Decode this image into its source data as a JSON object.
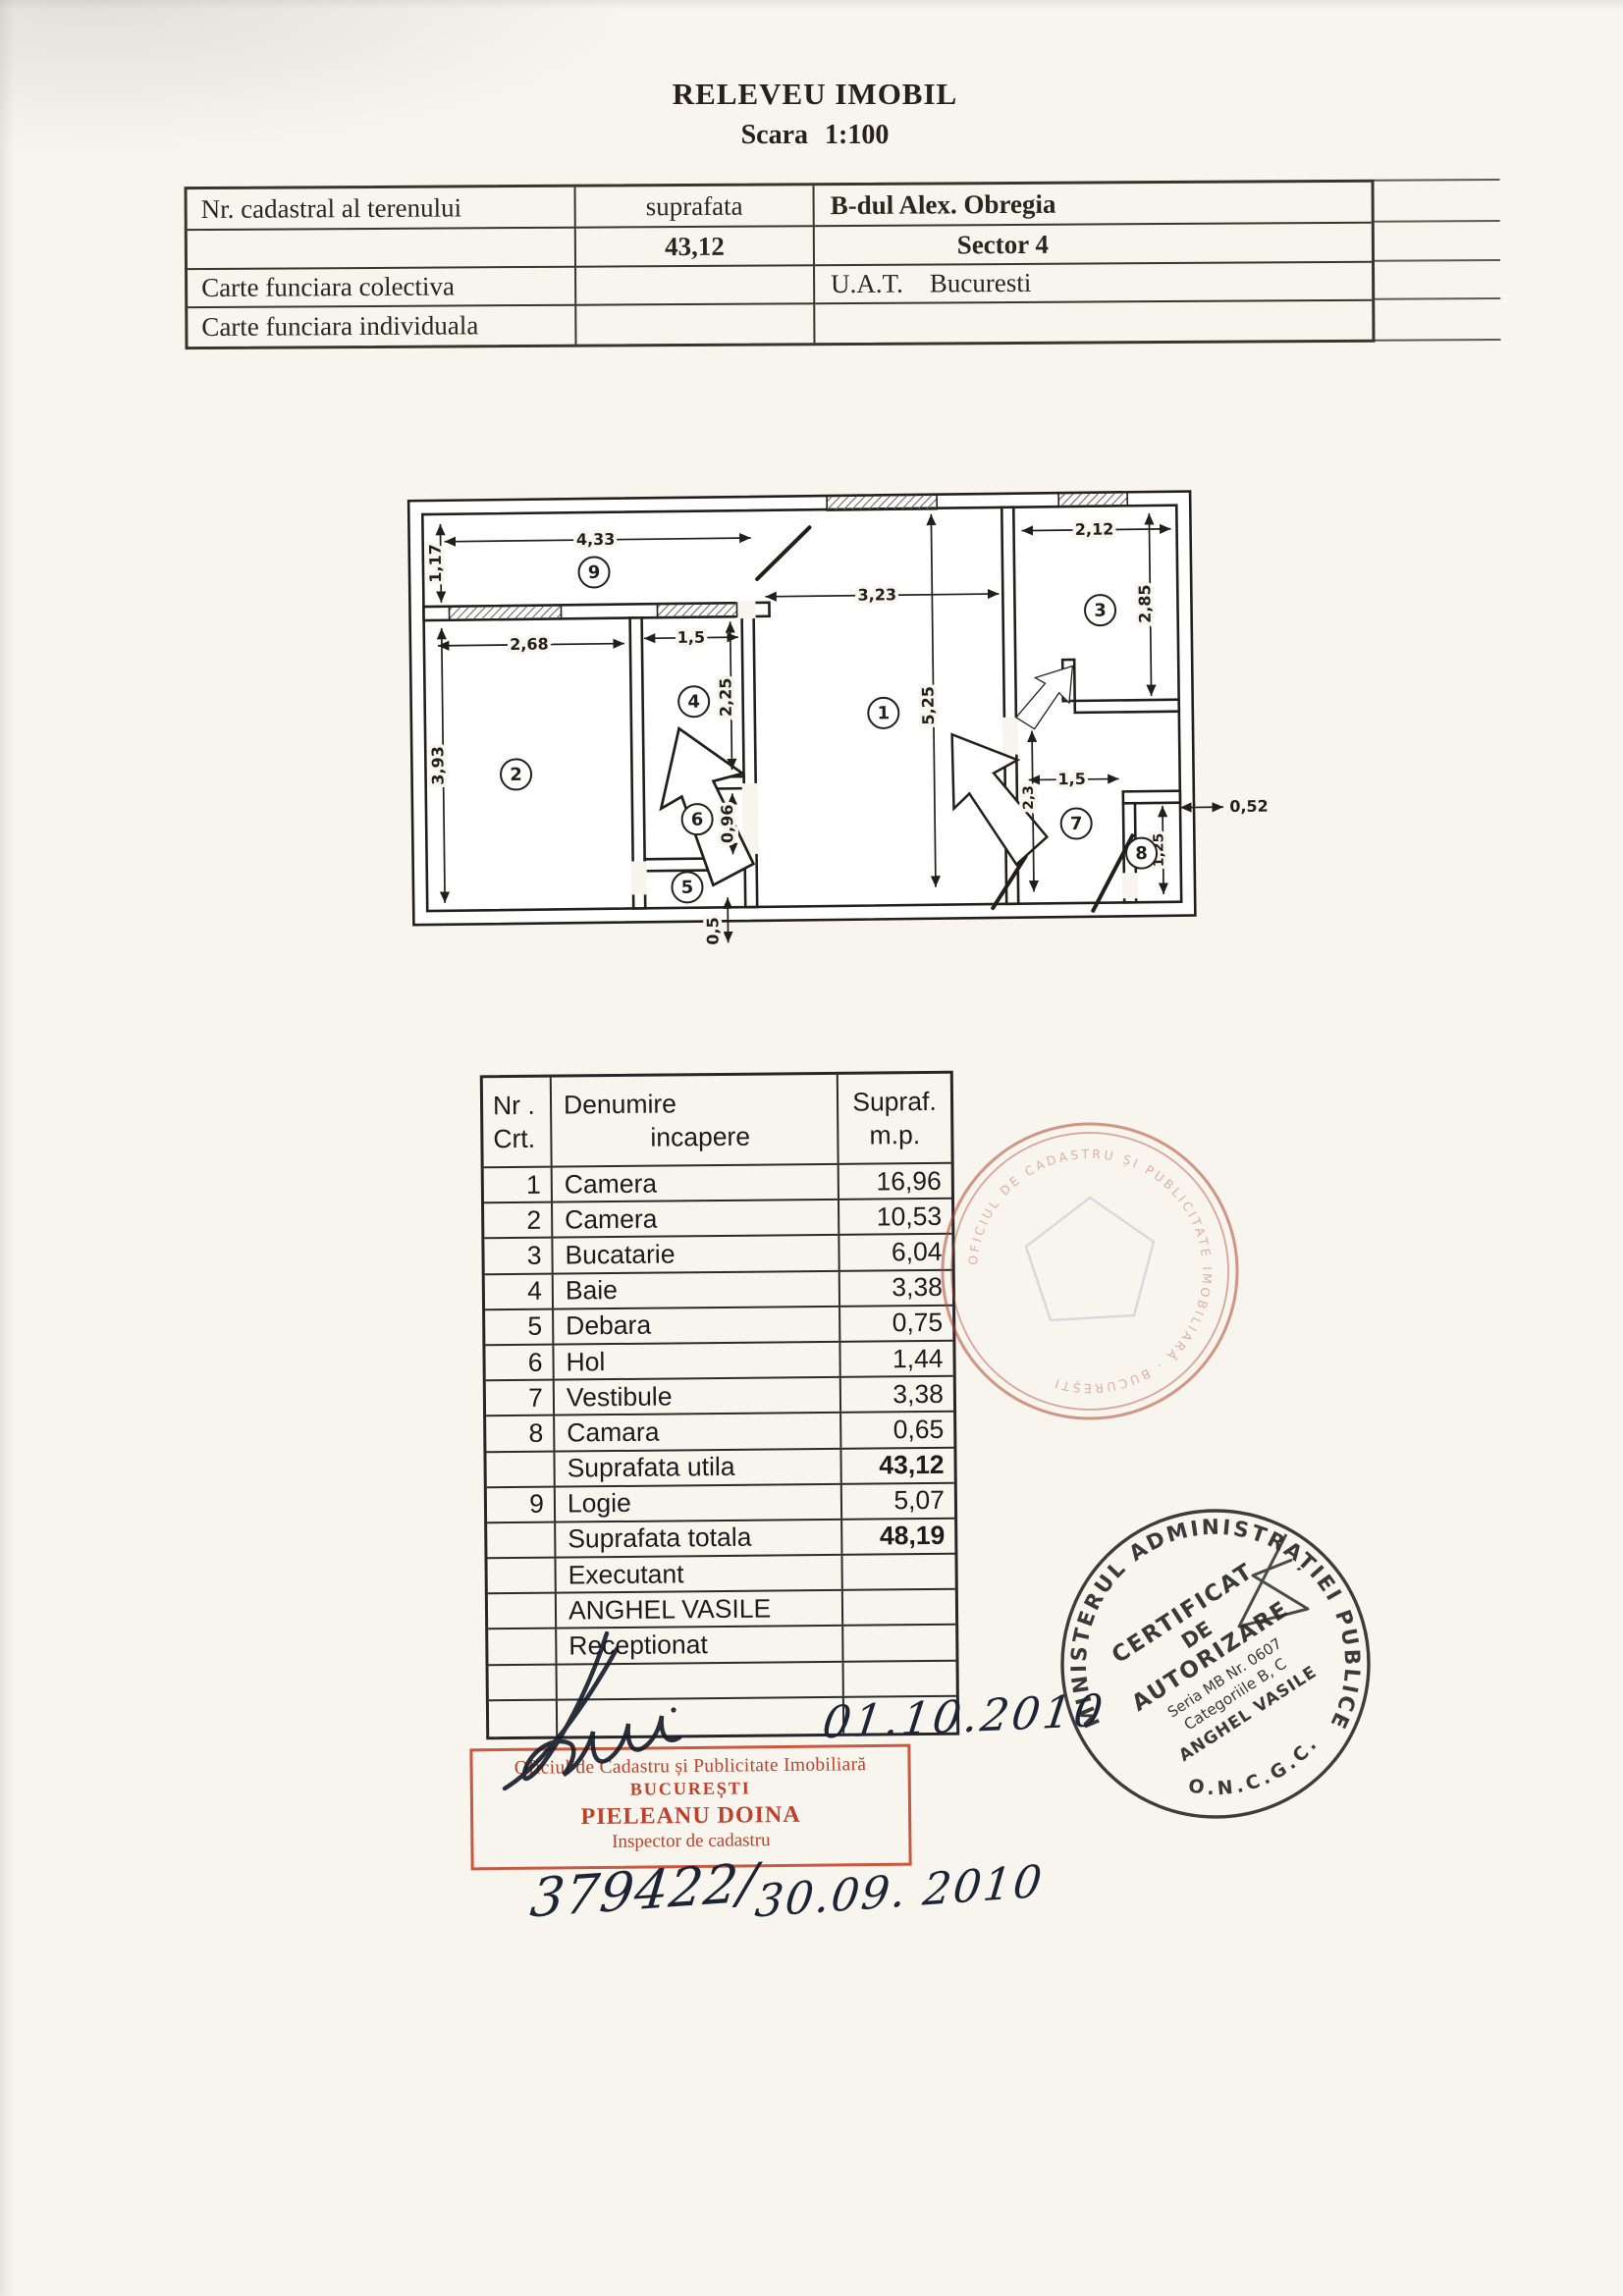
{
  "page": {
    "title": "RELEVEU IMOBIL",
    "scale": "Scara 1:100"
  },
  "info_table": {
    "rows": [
      [
        "Nr. cadastral al terenului",
        "suprafata",
        "B-dul Alex. Obregia"
      ],
      [
        "",
        "43,12",
        "Sector 4"
      ],
      [
        "Carte funciara colectiva",
        "",
        "U.A.T.    Bucuresti"
      ],
      [
        "Carte funciara individuala",
        "",
        ""
      ]
    ]
  },
  "floor_plan": {
    "rooms": {
      "r1": "1",
      "r2": "2",
      "r3": "3",
      "r4": "4",
      "r5": "5",
      "r6": "6",
      "r7": "7",
      "r8": "8",
      "r9": "9"
    },
    "dims": {
      "logia_w": "4,33",
      "logia_h": "1,17",
      "room2_w": "2,68",
      "room2_h": "3,93",
      "bath_w": "1,5",
      "bath_h": "2,25",
      "hall_h": "0,96",
      "below_h": "0,5",
      "room1_w": "3,23",
      "room1_h": "5,25",
      "kitchen_w": "2,12",
      "kitchen_h": "2,85",
      "vest_w": "1,5",
      "vest_h": "2,3",
      "camara_w": "0,52",
      "camara_h": "1,25"
    }
  },
  "room_table": {
    "header": {
      "nr1": "Nr .",
      "nr2": "Crt.",
      "den1": "Denumire",
      "den2": "incapere",
      "sup1": "Supraf.",
      "sup2": "m.p."
    },
    "rows": [
      {
        "nr": "1",
        "name": "Camera",
        "area": "16,96"
      },
      {
        "nr": "2",
        "name": "Camera",
        "area": "10,53"
      },
      {
        "nr": "3",
        "name": "Bucatarie",
        "area": "6,04"
      },
      {
        "nr": "4",
        "name": "Baie",
        "area": "3,38"
      },
      {
        "nr": "5",
        "name": "Debara",
        "area": "0,75"
      },
      {
        "nr": "6",
        "name": "Hol",
        "area": "1,44"
      },
      {
        "nr": "7",
        "name": "Vestibule",
        "area": "3,38"
      },
      {
        "nr": "8",
        "name": "Camara",
        "area": "0,65"
      },
      {
        "nr": "",
        "name": "Suprafata utila",
        "area": "43,12"
      },
      {
        "nr": "9",
        "name": "Logie",
        "area": "5,07"
      },
      {
        "nr": "",
        "name": "Suprafata totala",
        "area": "48,19"
      },
      {
        "nr": "",
        "name": "Executant",
        "area": ""
      },
      {
        "nr": "",
        "name": "ANGHEL VASILE",
        "area": ""
      },
      {
        "nr": "",
        "name": "Receptionat",
        "area": ""
      },
      {
        "nr": "",
        "name": "",
        "area": ""
      },
      {
        "nr": "",
        "name": "",
        "area": ""
      }
    ]
  },
  "stamps": {
    "red_box": {
      "line1": "Oficiul de Cadastru și Publicitate Imobiliară",
      "line2": "BUCUREȘTI",
      "line3": "PIELEANU DOINA",
      "line4": "Inspector de cadastru"
    },
    "round": {
      "arc_top": "MINISTERUL ADMINISTRAȚIEI PUBLICE",
      "arc_bottom": "O.N.C.G.C.",
      "center": [
        "CERTIFICAT",
        "DE",
        "AUTORIZARE",
        "Seria MB Nr. 0607",
        "Categoriile B, C",
        "ANGHEL VASILE"
      ]
    },
    "faint": {
      "arc": "OFICIUL DE CADASTRU ȘI PUBLICITATE IMOBILIARĂ · BUCUREȘTI"
    }
  },
  "handwriting": {
    "date": "01.10.2010",
    "reg_left": "379422/",
    "reg_right": "30.09. 2010"
  }
}
